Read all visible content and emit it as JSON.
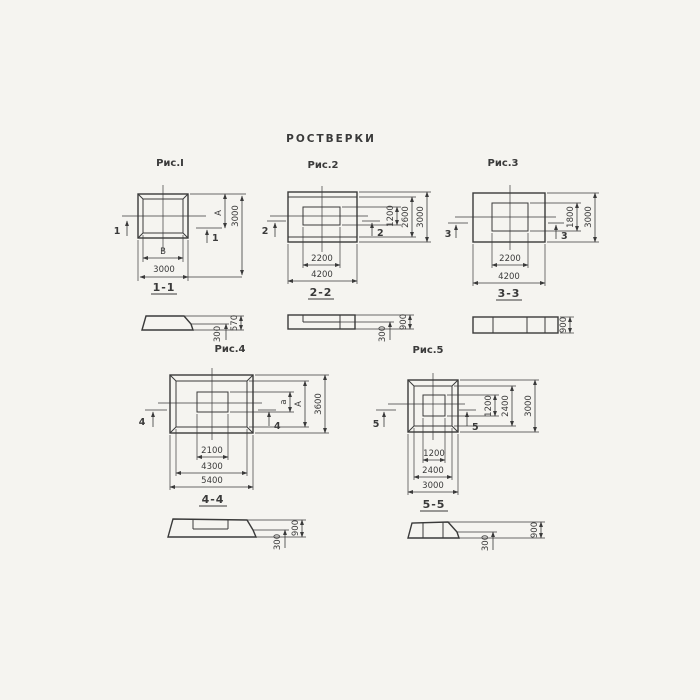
{
  "page": {
    "title": "РОСТВЕРКИ"
  },
  "colors": {
    "ink": "#3a3a3a",
    "background": "#f5f4f0"
  },
  "fig1": {
    "title": "Рис.I",
    "cut": "1",
    "section_label": "1-1",
    "dim_inner_width": "В",
    "dim_outer_width": "3000",
    "dim_inner_height": "А",
    "dim_outer_height": "3000"
  },
  "fig2": {
    "title": "Рис.2",
    "cut": "2",
    "section_label": "2-2",
    "dim_inner_width": "2200",
    "dim_outer_width": "4200",
    "dim_right_1": "1200",
    "dim_right_2": "2600",
    "dim_right_3": "3000"
  },
  "fig3": {
    "title": "Рис.3",
    "cut": "3",
    "section_label": "3-3",
    "dim_inner_width": "2200",
    "dim_outer_width": "4200",
    "dim_right_1": "1800",
    "dim_right_2": "3000"
  },
  "fig4": {
    "title": "Рис.4",
    "cut": "4",
    "section_label": "4-4",
    "dim_bottom_1": "2100",
    "dim_bottom_2": "4300",
    "dim_bottom_3": "5400",
    "dim_right_1": "а",
    "dim_right_2": "А",
    "dim_right_3": "3600"
  },
  "fig5": {
    "title": "Рис.5",
    "cut": "5",
    "section_label": "5-5",
    "dim_bottom_1": "1200",
    "dim_bottom_2": "2400",
    "dim_bottom_3": "3000",
    "dim_right_1": "1200",
    "dim_right_2": "2400",
    "dim_right_3": "3000"
  },
  "sec1": {
    "dim_total": "570",
    "dim_edge": "300"
  },
  "sec2": {
    "dim_total": "900",
    "dim_edge": "300"
  },
  "sec3": {
    "dim_total": "900"
  },
  "sec4": {
    "dim_total": "900",
    "dim_edge": "300"
  },
  "sec5": {
    "dim_total": "900",
    "dim_edge": "300"
  }
}
